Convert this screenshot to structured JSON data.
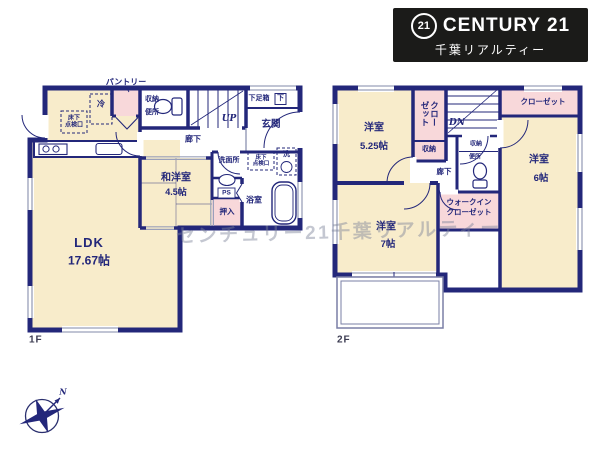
{
  "logo": {
    "badge": "21",
    "brand": "CENTURY 21",
    "subtitle": "千葉リアルティー"
  },
  "watermark": "センチュリー21千葉リアルティー",
  "compass": {
    "north": "N"
  },
  "colors": {
    "wall": "#23277a",
    "room_cream": "#f8eccb",
    "closet_pink": "#f8d8da",
    "window_gray": "#9aa0ba",
    "logo_bg": "#1b1b19"
  },
  "floor1": {
    "label": "1F",
    "ldk": {
      "name": "LDK",
      "area": "17.67帖"
    },
    "wayoshitsu": {
      "name": "和洋室",
      "area": "4.5帖"
    },
    "genkan": "玄関",
    "shoebox": "下足箱",
    "shoebox_abbr": "下",
    "hallway": "廊下",
    "stairs_up": "UP",
    "toilet": {
      "storage": "収納",
      "label": "便所"
    },
    "pantry": "パントリー",
    "fridge": "冷",
    "hatch_kitchen": "床下\n点検口",
    "washroom": "洗面所",
    "hatch_washroom": "床下\n点検口",
    "laundry": "洗",
    "pipe_space": "PS",
    "bathroom": "浴室",
    "oshiire": "押入"
  },
  "floor2": {
    "label": "2F",
    "bedroom_a": {
      "name": "洋室",
      "area": "5.25帖"
    },
    "bedroom_b": {
      "name": "洋室",
      "area": "6帖"
    },
    "bedroom_c": {
      "name": "洋室",
      "area": "7帖"
    },
    "closet_a": "クローゼット",
    "closet_b": "クローゼット",
    "storage": "収納",
    "toilet": {
      "storage": "収納",
      "label": "便所"
    },
    "hallway": "廊下",
    "stairs_down": "DN",
    "walk_in_closet": "ウォークインクローゼット"
  }
}
